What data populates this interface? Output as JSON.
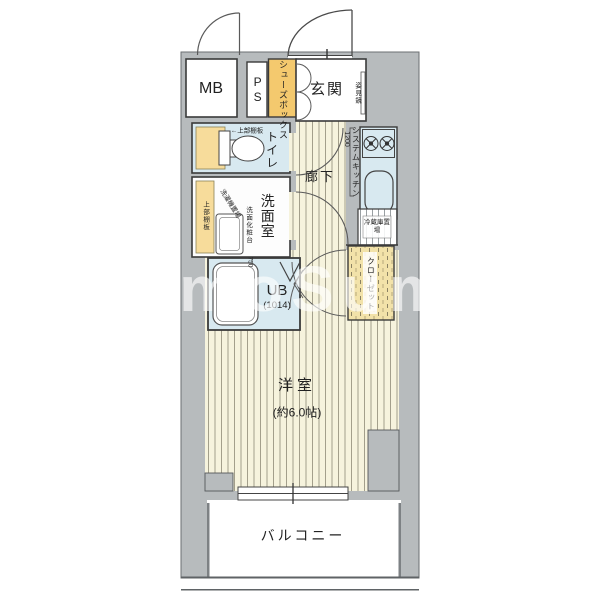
{
  "colors": {
    "slab": "#b7bbbd",
    "floor": "#f6f3dd",
    "floorline": "#a39f8b",
    "blue": "#d8e9f0",
    "yellow": "#f4c96e",
    "yellow2": "#f7dc9b",
    "closet": "#f2e2a9",
    "wall": "#3a3a3a",
    "text": "#222222",
    "wm": "rgba(255,255,255,0.62)"
  },
  "rooms": {
    "mb": {
      "label": "MB"
    },
    "ps": {
      "label": "PS"
    },
    "shoe_box": {
      "label": "シューズボックス"
    },
    "genkan": {
      "label": "玄関",
      "mirror": "姿見鏡"
    },
    "toilet": {
      "label": "トイレ",
      "shelf_note": "←上部棚板"
    },
    "washroom": {
      "label": "洗面室",
      "shelf": "上部棚板",
      "washer": "洗濯機置場",
      "vanity": "洗面化粧台",
      "vanity_size": "750"
    },
    "bath": {
      "label": "UB",
      "size": "(1014)"
    },
    "hallway": {
      "label": "廊下"
    },
    "kitchen": {
      "label": "システムキッチン",
      "size": "1200"
    },
    "fridge": {
      "label": "冷蔵庫置場"
    },
    "closet": {
      "label": "クローゼット"
    },
    "living": {
      "label": "洋室",
      "size": "(約6.0帖)"
    },
    "balcony": {
      "label": "バルコニー"
    }
  },
  "watermark": {
    "text": "umoSumo"
  }
}
